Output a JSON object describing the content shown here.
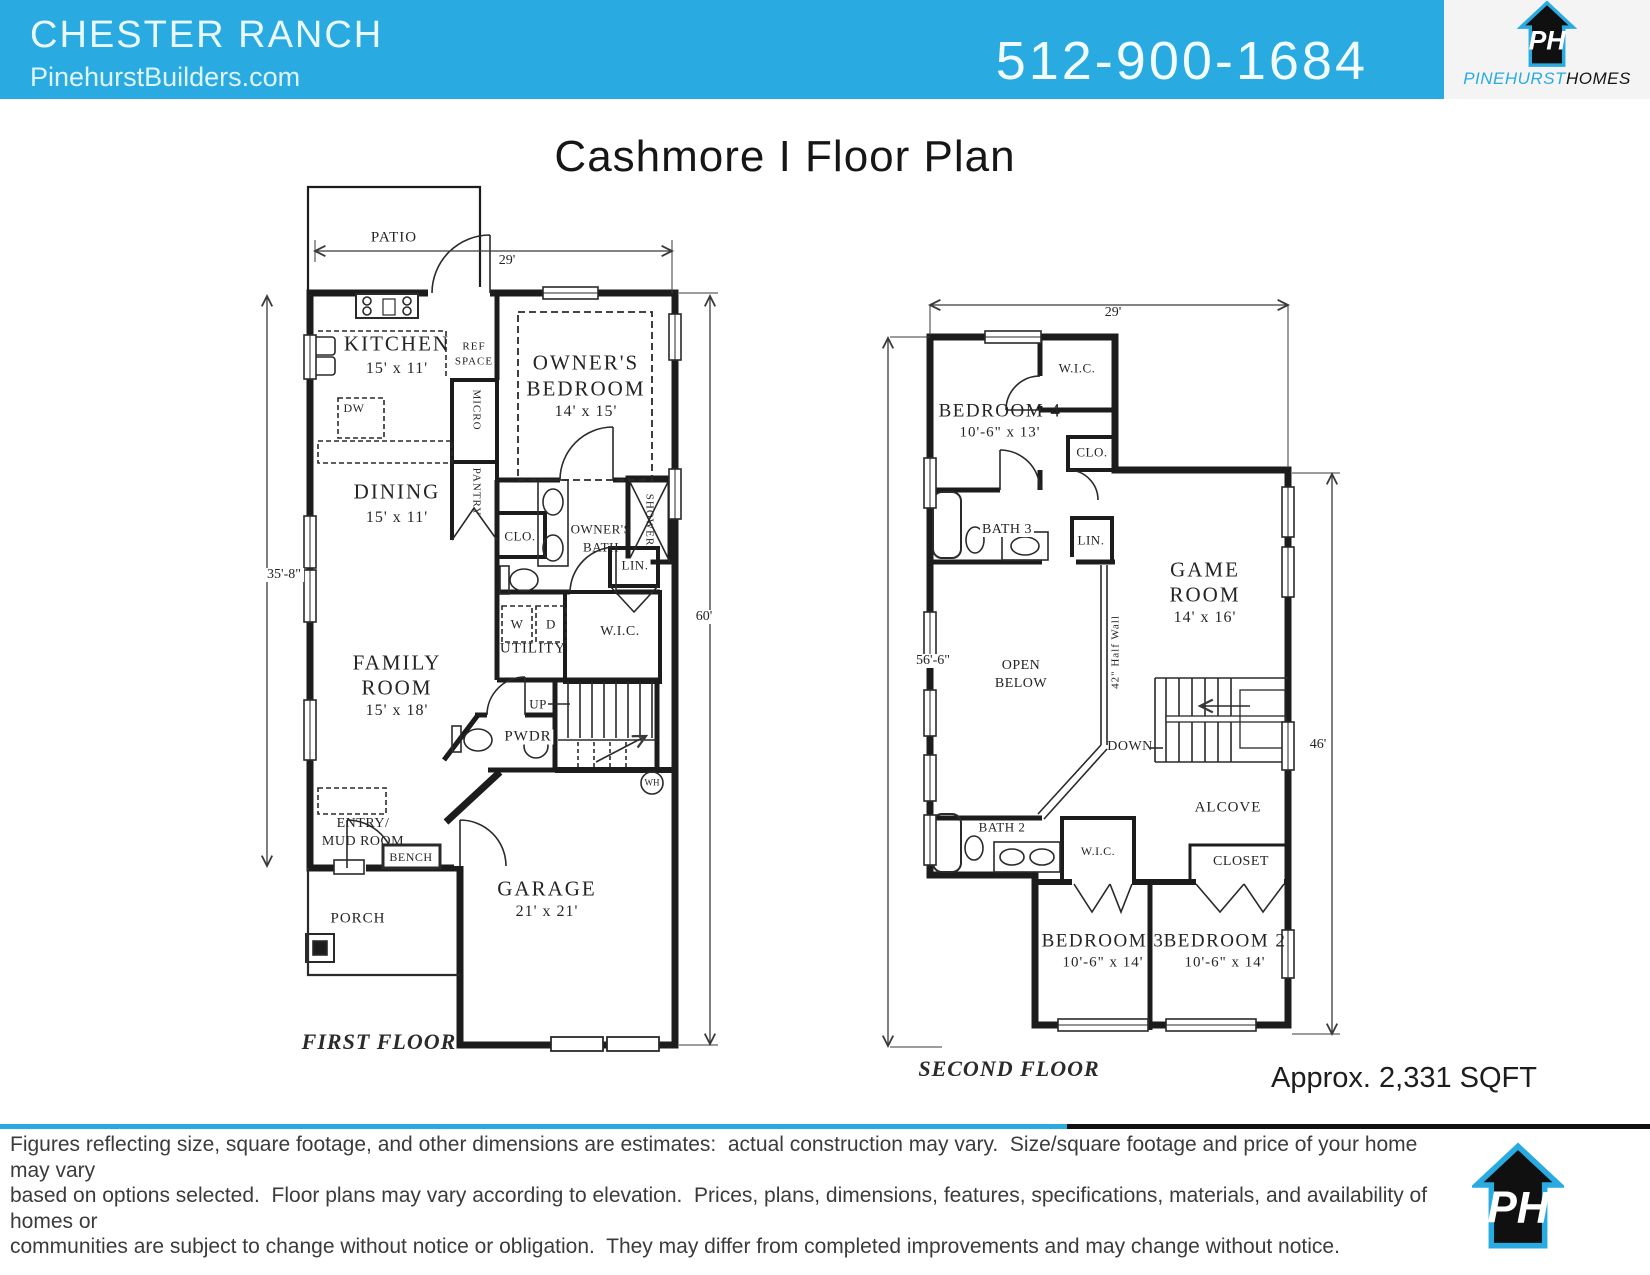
{
  "header": {
    "community": "CHESTER RANCH",
    "website": "PinehurstBuilders.com",
    "phone": "512-900-1684",
    "logo": {
      "initials": "PH",
      "brand_primary": "PINEHURST",
      "brand_secondary": "HOMES"
    }
  },
  "title": "Cashmore I Floor Plan",
  "approx_sqft": "Approx. 2,331 SQFT",
  "colors": {
    "accent": "#29ABE2"
  },
  "first_floor": {
    "caption": "FIRST FLOOR",
    "dim_width": "29'",
    "dim_left": "35'-8\"",
    "dim_right": "60'",
    "labels": {
      "patio": "PATIO",
      "kitchen": "KITCHEN",
      "kitchen_size": "15' x 11'",
      "ref_1": "REF",
      "ref_2": "SPACE",
      "micro": "MICRO",
      "pantry": "PANTRY",
      "dw": "DW",
      "owners_bedroom_1": "OWNER'S",
      "owners_bedroom_2": "BEDROOM",
      "owners_bedroom_size": "14' x 15'",
      "dining": "DINING",
      "dining_size": "15' x 11'",
      "clo": "CLO.",
      "owners_bath_1": "OWNER'S",
      "owners_bath_2": "BATH",
      "shower": "SHOWER",
      "lin": "LIN.",
      "w": "W",
      "d": "D",
      "utility": "UTILITY",
      "wic": "W.I.C.",
      "family_1": "FAMILY",
      "family_2": "ROOM",
      "family_size": "15' x 18'",
      "up": "UP",
      "pwdr": "PWDR",
      "wh": "WH",
      "entry_1": "ENTRY/",
      "entry_2": "MUD ROOM",
      "bench": "BENCH",
      "porch": "PORCH",
      "garage": "GARAGE",
      "garage_size": "21' x 21'"
    }
  },
  "second_floor": {
    "caption": "SECOND FLOOR",
    "dim_width": "29'",
    "dim_left": "56'-6\"",
    "dim_right": "46'",
    "labels": {
      "wic_top": "W.I.C.",
      "bedroom4": "BEDROOM 4",
      "bedroom4_size": "10'-6\" x 13'",
      "clo": "CLO.",
      "bath3": "BATH 3",
      "lin": "LIN.",
      "game_1": "GAME",
      "game_2": "ROOM",
      "game_size": "14' x 16'",
      "open_1": "OPEN",
      "open_2": "BELOW",
      "half_wall": "42\" Half Wall",
      "down": "DOWN",
      "alcove": "ALCOVE",
      "bath2": "BATH 2",
      "wic2": "W.I.C.",
      "closet": "CLOSET",
      "bedroom3": "BEDROOM 3",
      "bedroom3_size": "10'-6\" x 14'",
      "bedroom2": "BEDROOM 2",
      "bedroom2_size": "10'-6\" x 14'"
    }
  },
  "footer": {
    "line1": "Figures reflecting size, square footage, and other dimensions are estimates:  actual construction may vary.  Size/square footage and price of your home may vary",
    "line2": "based on options selected.  Floor plans may vary according to elevation.  Prices, plans, dimensions, features, specifications, materials, and availability of homes or",
    "line3": "communities are subject to change without notice or obligation.  They may differ from completed improvements and may change without notice."
  }
}
